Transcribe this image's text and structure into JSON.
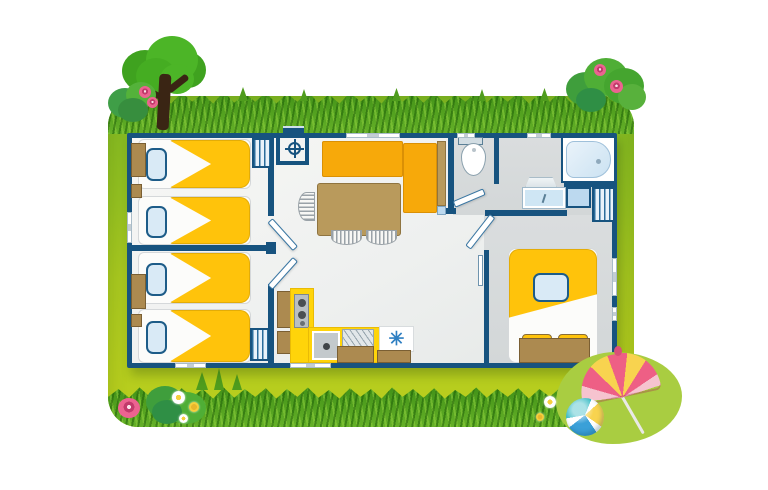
{
  "scene": {
    "type": "campsite-mobile-home-floor-plan-illustration",
    "canvas": {
      "width": 768,
      "height": 490
    },
    "contains_text": false
  },
  "palette": {
    "frame_green_top": "#7FB622",
    "frame_green_bottom": "#BCCF1D",
    "grass_dark": "#3F8F17",
    "grass_light": "#65B028",
    "wall_blue": "#17537F",
    "floor_light": "#F2F3F1",
    "floor_gray": "#D8DADB",
    "bed_yellow": "#FFC30B",
    "sofa_orange": "#F7A90A",
    "kitchen_yellow": "#FFD40A",
    "wood_tan": "#B99A5C",
    "wood_brown": "#AC8A50",
    "pillow_blue": "#D9EAF6",
    "tub_blue": "#CBE2F2",
    "tree_green": "#4CB527",
    "trunk_brown": "#3A2514",
    "flower_pink": "#EC6390",
    "umbrella_pink": "#EE5F85",
    "umbrella_yellow": "#F8D34F",
    "umbrella_pale_pink": "#F6C3CF",
    "ball_blue": "#3AA0D8",
    "ball_teal": "#45C0C9",
    "ball_yellow": "#F8D34F"
  },
  "floor_plan": {
    "rooms": [
      {
        "id": "bedroom-1",
        "kind": "twin bedroom",
        "furniture": [
          "single-bed",
          "single-bed",
          "pillow",
          "pillow",
          "nightstand",
          "shelf"
        ]
      },
      {
        "id": "bedroom-2",
        "kind": "twin bedroom",
        "furniture": [
          "single-bed",
          "single-bed",
          "pillow",
          "pillow",
          "nightstand",
          "shelf",
          "wardrobe"
        ]
      },
      {
        "id": "entrance",
        "kind": "entry hall",
        "furniture": [
          "entry-step",
          "wardrobe",
          "water-heater"
        ]
      },
      {
        "id": "living-dining",
        "kind": "living / dining room",
        "furniture": [
          "l-shaped-bench",
          "dining-table",
          "chair",
          "chair",
          "chair"
        ]
      },
      {
        "id": "kitchen",
        "kind": "kitchenette",
        "furniture": [
          "cooktop",
          "sink",
          "draining-board",
          "fridge",
          "cabinet",
          "cabinet",
          "cabinet",
          "cabinet"
        ]
      },
      {
        "id": "bathroom",
        "kind": "shower room / WC",
        "furniture": [
          "toilet",
          "bathtub",
          "washbasin",
          "mirror",
          "shower-tray",
          "wardrobe"
        ]
      },
      {
        "id": "master-bedroom",
        "kind": "double bedroom",
        "furniture": [
          "double-bed",
          "pillow",
          "bench-with-two-cushions",
          "sliding-door"
        ]
      }
    ],
    "openings": {
      "windows": 8,
      "hinged_doors": 4,
      "sliding_doors": 1,
      "entry_steps": 1
    },
    "fridge_symbol": "✳"
  },
  "decorations": {
    "top_left": [
      "tree",
      "bush",
      "pink-flowers",
      "grass"
    ],
    "top_right": [
      "bush",
      "pink-flowers"
    ],
    "bottom_left": [
      "bush",
      "pink-flower",
      "daisies",
      "grass-tufts"
    ],
    "bottom_right": [
      "light-green-bush",
      "beach-umbrella",
      "beach-ball",
      "daisies"
    ]
  }
}
